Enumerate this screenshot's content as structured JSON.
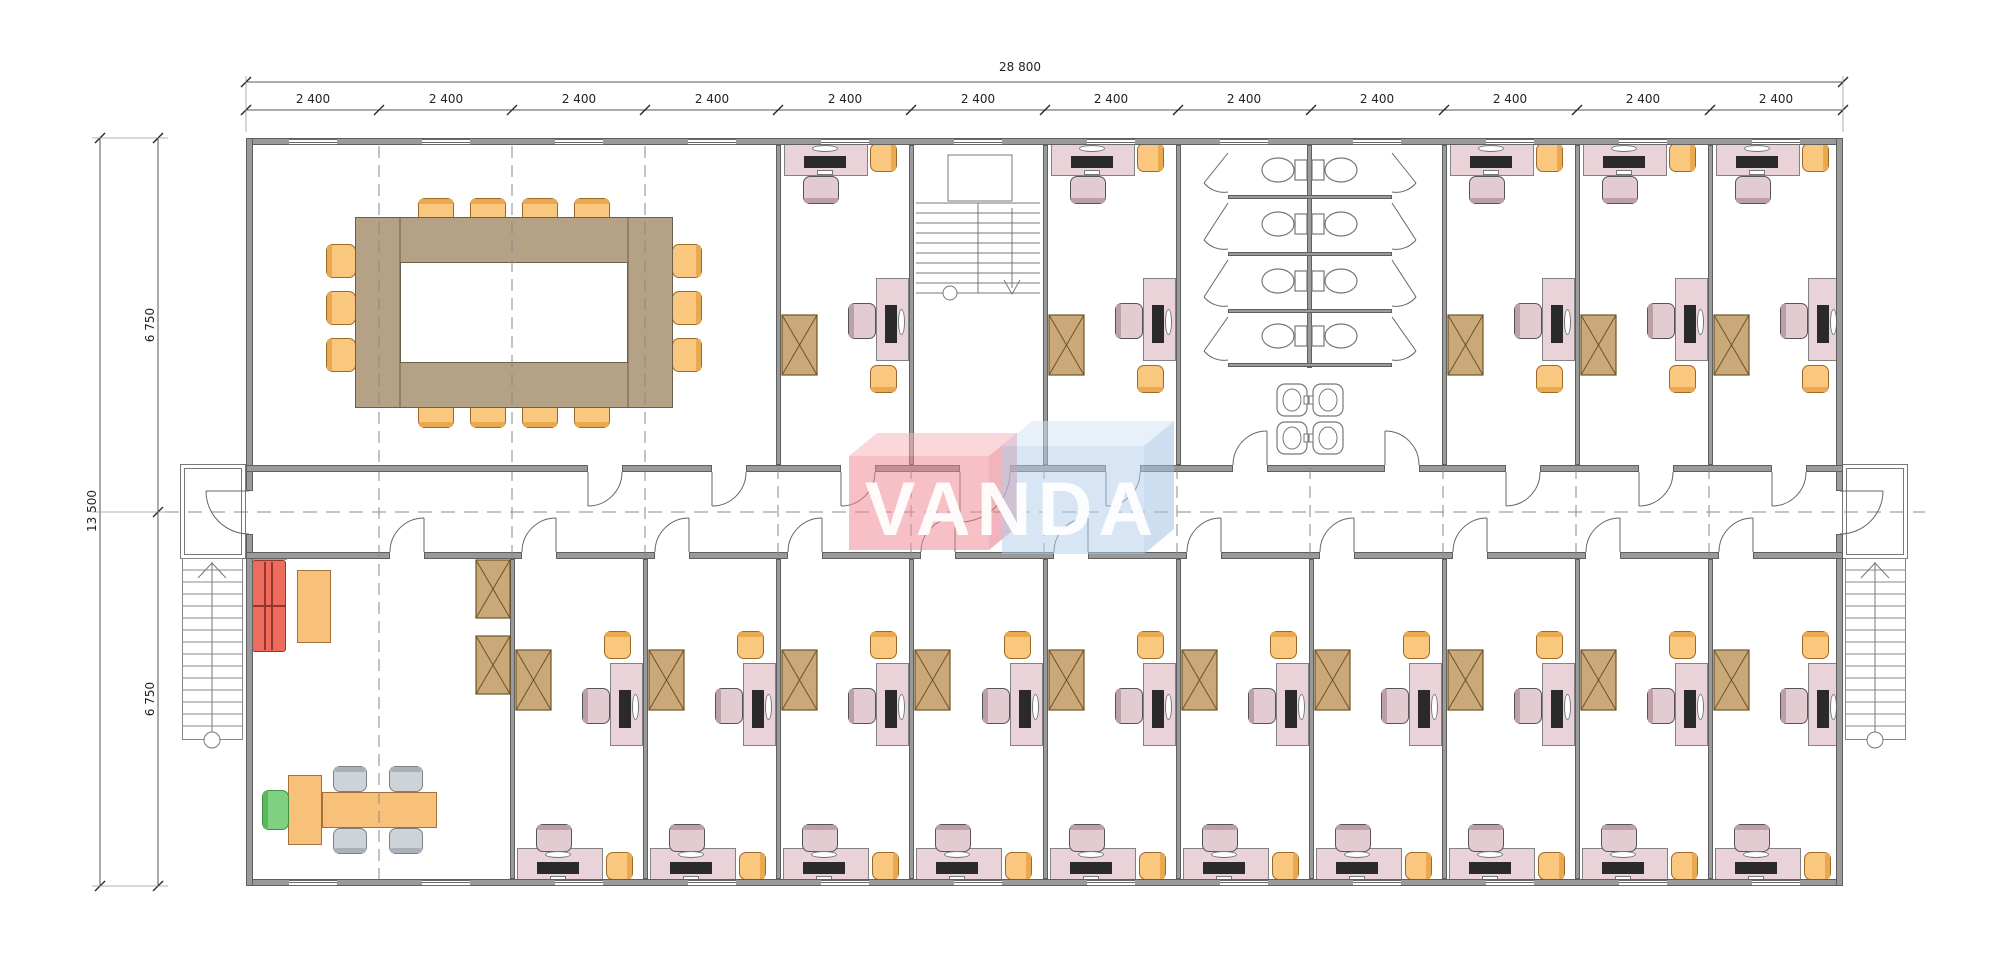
{
  "drawing": {
    "kind": "architectural-floor-plan",
    "building_modules": 12
  },
  "watermark": {
    "text": "VANDA",
    "red_box_front": "#ef8591",
    "red_box_top": "#f6b3ba",
    "red_box_side": "#e6707e",
    "blue_box_front": "#b3cde9",
    "blue_box_top": "#d3e3f4",
    "blue_box_side": "#9fc0e2",
    "text_color": "#ffffff"
  },
  "dimensions": {
    "top_total": "28 800",
    "top_segments": [
      "2 400",
      "2 400",
      "2 400",
      "2 400",
      "2 400",
      "2 400",
      "2 400",
      "2 400",
      "2 400",
      "2 400",
      "2 400",
      "2 400"
    ],
    "left_total": "13 500",
    "left_segments": [
      "6 750",
      "6 750"
    ]
  },
  "palette": {
    "wall": "#9a9a9a",
    "wall_edge": "#5f5f5f",
    "thin_line": "#777777",
    "dash_line": "#8a8a8a",
    "dim_line": "#555555",
    "conference_table": "#b5a185",
    "conference_table_edge": "#6a604b",
    "chair_orange": "#f9c87e",
    "chair_orange_edge": "#9c6a26",
    "chair_orange_band": "#eaa94f",
    "desk_pink": "#e9d3d8",
    "desk_edge": "#828282",
    "chair_pink": "#e3ccd1",
    "chair_pink_band": "#bda0a7",
    "cabinet": "#c9a979",
    "cabinet_edge": "#6d5426",
    "sofa_red": "#ee6c5d",
    "sofa_edge": "#93362b",
    "table_orange": "#f8c17a",
    "table_orange_edge": "#a4713a",
    "chair_green": "#7fd080",
    "chair_green_edge": "#3f8f3f",
    "chair_gray": "#ced3da",
    "chair_gray_edge": "#7a7f88",
    "teal": "#6fb6b6",
    "computer_dark": "#2a2a2a"
  }
}
